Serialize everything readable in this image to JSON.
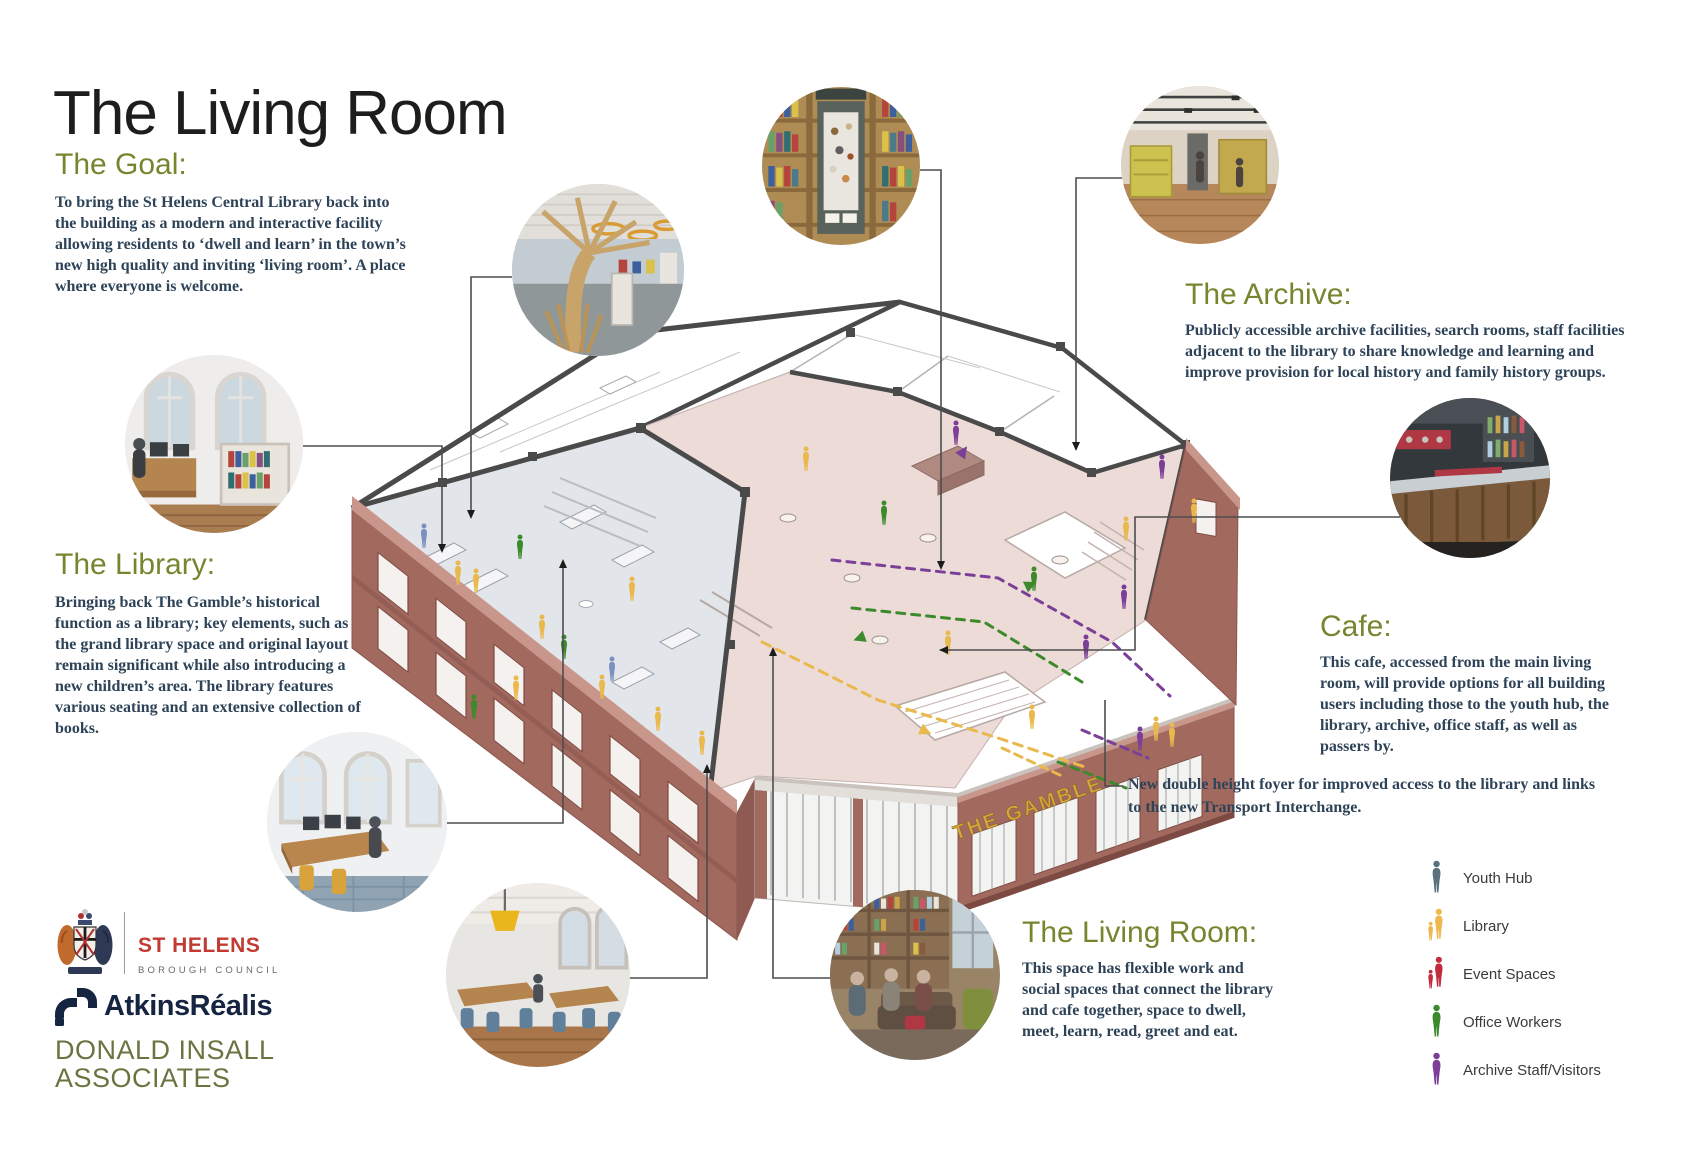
{
  "poster": {
    "title": "The Living Room",
    "sections": {
      "goal": {
        "heading": "The Goal:",
        "body": "To bring the St Helens Central Library back into the building as a modern and interactive facility allowing residents to ‘dwell and learn’ in the town’s new high quality and inviting ‘living room’. A place where everyone is welcome."
      },
      "library": {
        "heading": "The Library:",
        "body": "Bringing back The Gamble’s historical function as a library; key elements, such as the grand library space and original layout remain significant while also introducing a new children’s area. The library features various seating and an extensive collection of books."
      },
      "archive": {
        "heading": "The Archive:",
        "body": "Publicly accessible archive facilities, search rooms, staff facilities adjacent to the library to share knowledge and learning and improve provision for local history and family history groups."
      },
      "cafe": {
        "heading": "Cafe:",
        "body": "This cafe, accessed from the main living room, will provide options for all building users including those to the youth hub, the library, archive, office staff, as well as passers by."
      },
      "living_room": {
        "heading": "The Living Room:",
        "body": "This space has flexible work and social spaces that connect the library and cafe together, space to dwell, meet, learn, read, greet and eat."
      }
    },
    "annotation_foyer": "New double height foyer for improved access to the library and links to the new Transport Interchange.",
    "building": {
      "sign": "THE GAMBLE"
    },
    "legend": {
      "items": [
        {
          "label": "Youth Hub",
          "color": "#5b7180",
          "icon": "person-adult-icon"
        },
        {
          "label": "Library",
          "color": "#eeb84e",
          "icon": "person-adult-child-icon"
        },
        {
          "label": "Event Spaces",
          "color": "#c12b3c",
          "icon": "person-adult-child-icon"
        },
        {
          "label": "Office Workers",
          "color": "#3c8a2c",
          "icon": "person-adult-icon"
        },
        {
          "label": "Archive Staff/Visitors",
          "color": "#7c3f98",
          "icon": "person-adult-icon"
        }
      ]
    },
    "logos": {
      "st_helens": {
        "name": "ST HELENS",
        "subtitle": "BOROUGH COUNCIL"
      },
      "atkins_realis": {
        "name": "AtkinsRéalis"
      },
      "donald_insall": {
        "line1": "DONALD INSALL",
        "line2": "ASSOCIATES"
      }
    },
    "photos": {
      "archive_display": "archive-display-bookcase-photo",
      "library_interior": "library-interior-photo",
      "childrens_tree": "childrens-area-tree-photo",
      "search_room": "search-room-desk-photo",
      "cafe_counter": "cafe-counter-photo",
      "office": "office-workspace-photo",
      "open_plan": "open-plan-study-photo",
      "living_room": "living-room-lounge-photo"
    },
    "colors": {
      "heading_olive": "#76862f",
      "body_ink": "#2e4357",
      "brick": "#a2695f",
      "brick_dark": "#8a564e",
      "floor_grey": "#e2e5ea",
      "floor_pink": "#ecdbd7",
      "cut_wall": "#4a4a4a",
      "sign_gold": "#d7a73f",
      "st_helens_red": "#c23a32",
      "atkins_navy": "#152440",
      "insall_olive": "#6b7440"
    }
  }
}
